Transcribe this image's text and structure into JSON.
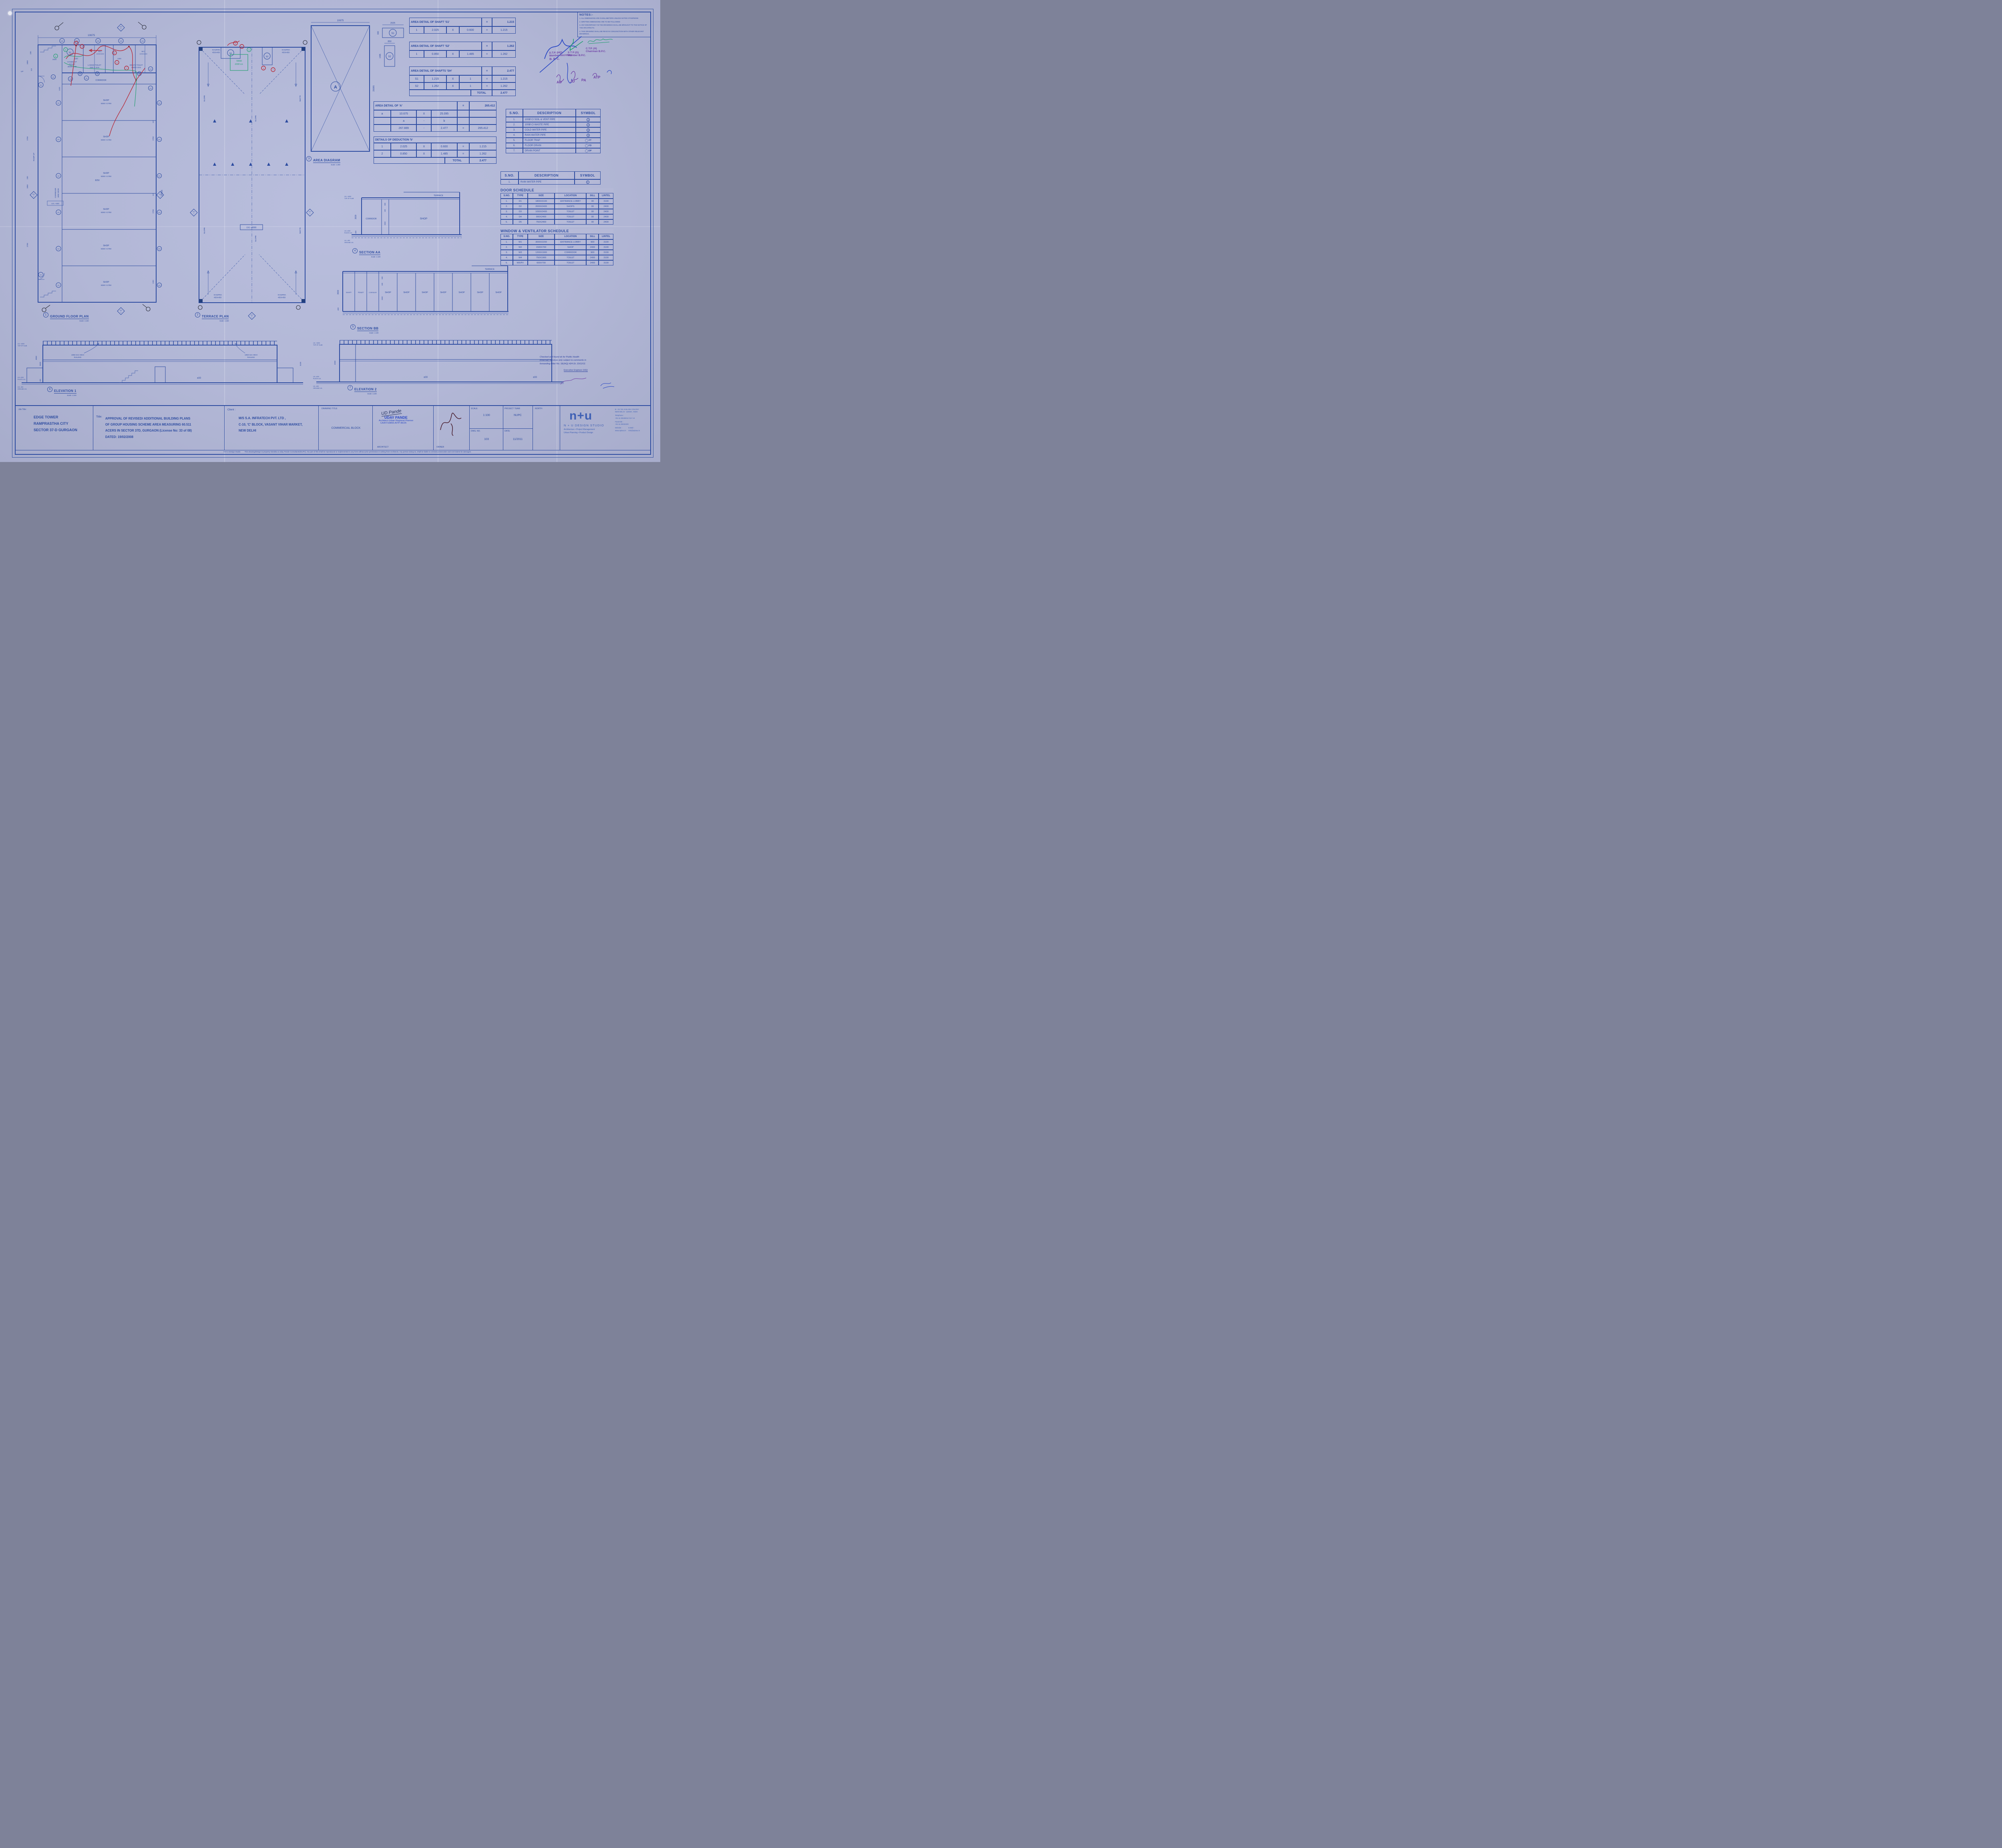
{
  "palette": {
    "paper": "#b6bbd8",
    "ink": "#2c4ba0",
    "red": "#b7202e",
    "green": "#1d9e6d",
    "purple": "#6f41a6",
    "pen_blue": "#2a3f9e"
  },
  "notes": {
    "title": "NOTES:-",
    "items": [
      "1.   ALL DIMENSIONS ARE IN MILLIMETERS UNLESS NOTED OTHERWISE",
      "2.   WRITTEN DIMENSIONS ARE TO BE FOLLOWED",
      "3.   ANY DISCRIPANCY IN THE DRAWINGS SHALL BE BROUGHT TO THE NOTICE OF THE ARCHITECTS.",
      "4.   THIS DRAWING SHALL BE READ IN CONJUNCTION WITH OTHER RELEVANT DRAWINGS."
    ]
  },
  "approvals": {
    "dtp": [
      "D.T.P. (HQ)",
      "Member Secretary",
      "B. P. C."
    ],
    "stp": [
      "S T P (G)",
      "Member B.P.C."
    ],
    "ctp": [
      "C.T.P. (H)",
      "Chairman B.P.C."
    ],
    "initials": [
      "AD",
      "JD",
      "PA",
      "ATP"
    ]
  },
  "shaft_s1": {
    "title": "AREA DETAIL OF  SHAFT 'S1'",
    "eq": "=",
    "total": "1.215",
    "rows": [
      [
        "1",
        "2.025",
        "X",
        "0.600",
        "=",
        "1.215"
      ]
    ]
  },
  "shaft_s2": {
    "title": "AREA DETAIL OF  SHAFT 'S2'",
    "eq": "=",
    "total": "1.262",
    "rows": [
      [
        "1",
        "0.850",
        "X",
        "1.485",
        "=",
        "1.262"
      ]
    ]
  },
  "shaft_sh": {
    "title": "AREA DETAIL OF  SHAFTS 'SH'",
    "eq": "=",
    "total": "2.477",
    "rows": [
      [
        "S1",
        "1.215",
        "X",
        "1",
        "=",
        "1.215"
      ],
      [
        "S2",
        "1.262",
        "X",
        "1",
        "=",
        "1.262"
      ]
    ],
    "footer_label": "TOTAL",
    "footer_value": "2.477"
  },
  "area_a": {
    "title": "AREA DETAIL OF 'A'",
    "eq": "=",
    "total": "265.412",
    "rows": [
      [
        "a",
        "10.675",
        "X",
        "25.095",
        "",
        ""
      ],
      [
        "",
        "a",
        "-",
        "b",
        "",
        ""
      ],
      [
        "",
        "267.889",
        "-",
        "2.477",
        "=",
        "265.412"
      ]
    ]
  },
  "deduction_b": {
    "title": "DETAILS OF DEDUCTION 'b'",
    "rows": [
      [
        "1",
        "2.025",
        "X",
        "0.600",
        "=",
        "1.215"
      ],
      [
        "2",
        "0.850",
        "X",
        "1.485",
        "=",
        "1.262"
      ]
    ],
    "footer_label": "TOTAL",
    "footer_value": "2.477"
  },
  "legend": {
    "headers": [
      "S.NO.",
      "DESCRIPTION",
      "SYMBOL"
    ],
    "rows": [
      {
        "no": "1.",
        "desc": "100Ø CI SOIL & VENT PIPE",
        "sym": "1",
        "type": "num"
      },
      {
        "no": "2.",
        "desc": "100Ø CI WASTE PIPE",
        "sym": "2",
        "type": "num"
      },
      {
        "no": "3.",
        "desc": "COLD WATER PIPE",
        "sym": "3",
        "type": "num"
      },
      {
        "no": "4.",
        "desc": "RAIN WATER PIPE",
        "sym": "4",
        "type": "num"
      },
      {
        "no": "5.",
        "desc": "FLOOR TRAP",
        "sym": "FT",
        "type": "dot"
      },
      {
        "no": "6.",
        "desc": "FLOOR DRAIN",
        "sym": "FD",
        "type": "dot"
      },
      {
        "no": "7.",
        "desc": "DRAIN POINT",
        "sym": "DP",
        "type": "dot"
      }
    ]
  },
  "legend2": {
    "headers": [
      "S.NO.",
      "DESCRIPTION",
      "SYMBOL"
    ],
    "rows": [
      {
        "no": "1.",
        "desc": "RAIN WATER PIPE",
        "sym": "1",
        "type": "num"
      }
    ]
  },
  "door_schedule": {
    "title": "DOOR SCHEDULE",
    "headers": [
      "S.NO.",
      "TYPE",
      "SIZE",
      "LOCATION",
      "SILL",
      "LINTEL"
    ],
    "rows": [
      [
        "1.",
        "D1",
        "1800X3100",
        "ENTRANCE LOBBY",
        "00",
        "3100"
      ],
      [
        "2.",
        "D2",
        "2000X2400",
        "SHOPS",
        "00",
        "2400"
      ],
      [
        "3.",
        "D3",
        "1050X2400",
        "TOILET",
        "00",
        "2400"
      ],
      [
        "4.",
        "D4",
        "900X2400",
        "TOILET",
        "00",
        "2400"
      ],
      [
        "5.",
        "D5",
        "750X2400",
        "TOILET",
        "00",
        "2400"
      ]
    ]
  },
  "window_schedule": {
    "title": "WINDOW & VENTILATOR SCHEDULE",
    "headers": [
      "S.NO.",
      "TYPE",
      "SIZE",
      "LOCATION",
      "SILL",
      "LINTEL"
    ],
    "rows": [
      [
        "1.",
        "W1",
        "3000X2200",
        "ENTRANCE LOBBY",
        "900",
        "3100"
      ],
      [
        "2.",
        "W2",
        "1500X700",
        "SHOP",
        "2400",
        "3100"
      ],
      [
        "3.",
        "W3",
        "1200X1900",
        "CORRIDOR",
        "900",
        "3100"
      ],
      [
        "4.",
        "W4",
        "750X1900",
        "TOILET",
        "2400",
        "3100"
      ],
      [
        "5.",
        "W5/PV",
        "600X700",
        "TOILET",
        "2400",
        "3100"
      ]
    ]
  },
  "drawing_labels": {
    "ground": {
      "num": "1",
      "title": "GROUND FLOOR PLAN",
      "scale": "Scale: 1:100"
    },
    "terrace": {
      "num": "2",
      "title": "TERRACE PLAN",
      "scale": "Scale: 1:100"
    },
    "area": {
      "num": "3",
      "title": "AREA DIAGRAM",
      "scale": "Scale: 1:200"
    },
    "secaa": {
      "num": "4",
      "title": "SECTION AA",
      "scale": "Scale: 1:100"
    },
    "secbb": {
      "num": "5",
      "title": "SECTION BB",
      "scale": "Scale: 1:100"
    },
    "elev1": {
      "num": "6",
      "title": "ELEVATION 1",
      "scale": "Scale: 1:100"
    },
    "elev2": {
      "num": "7",
      "title": "ELEVATION 2",
      "scale": "Scale: 1:100"
    }
  },
  "ground": {
    "dim_top": "10675",
    "dim_right": "25095",
    "w5": "W5",
    "d230": "230",
    "d1850": "1850",
    "d2025": "2025",
    "d115": "115",
    "d1200": "1200",
    "d1445": "1445",
    "d2750": "2750",
    "d8250": "8250",
    "d1250": "1250",
    "handicap": [
      "HANDICAP",
      "TOILET",
      "2000X 2305"
    ],
    "ladies": [
      "LADIES TOILET",
      "2500 X 3215"
    ],
    "gents": [
      "GENTS TOILET",
      "2500 X 3215"
    ],
    "wc": [
      "W.C.",
      "1200X1500"
    ],
    "corridor_top": "CORRIDOR",
    "corridor_left": [
      "CORRIDOR",
      "1850 WIDE"
    ],
    "ramp": "RAMP UP",
    "up": "UP",
    "lvl": "LVL +450",
    "shop_label": [
      "SHOP",
      "8250 X 2750"
    ],
    "tags": {
      "d1": "D1",
      "d2": "D2",
      "d3": "D3",
      "d4": "D4",
      "d5": "D5",
      "w2": "W2",
      "w3": "W3",
      "w4": "W4",
      "s1": "S1"
    },
    "sec_a": [
      "SEC",
      "A"
    ],
    "sec_b": [
      "SEC",
      "B"
    ]
  },
  "terrace": {
    "khurra": [
      "KHURRA",
      "450X450"
    ],
    "slope": "SLOPE",
    "tank": [
      "TANK",
      "1000 Ltr."
    ],
    "lvl": "LVL +4000",
    "s1": "S1",
    "s2": "S2"
  },
  "area_diagram": {
    "a": "A",
    "dim_top": "10675",
    "dim_right": "25095"
  },
  "shaft_detail": {
    "s1": "S1",
    "s1_w": "2025",
    "s1_h": "600",
    "s2": "S2",
    "s2_w": "850",
    "s2_h": "1485"
  },
  "section_aa": {
    "terrace": "TERRACE",
    "corridor": "CORRIDOR",
    "shop": "SHOP",
    "d3600": "3600",
    "d450": "450",
    "d150": "150",
    "d600": "600",
    "d3450": "3450",
    "levels": [
      [
        "LVL +4000",
        "TOP OF SLAB"
      ],
      [
        "LVL ±000",
        "PLINTH LVL"
      ],
      [
        "LVL -600",
        "GROUND LVL"
      ]
    ]
  },
  "section_bb": {
    "terrace": "TERRACE",
    "shaft": "SHAFT",
    "toilet": "TOILET",
    "corridor": "CORRIDOR",
    "shop": "SHOP",
    "d3600": "3600",
    "d450": "450",
    "d150": "150",
    "d600": "600",
    "d3450": "3450"
  },
  "elevation1": {
    "railing": [
      "1050 mm HIGH",
      "RAILING"
    ],
    "pm": "±00",
    "d4850": "4850",
    "d3600": "3600",
    "d450": "450",
    "d3100": "3100"
  },
  "elevation2": {
    "pm": "±00",
    "d4000": "4000"
  },
  "checked_stamp": {
    "lines": [
      "Checked and found ok for Public Health",
      "(Internal) Services only subject to comments in",
      "forwarding letter No. SE(HQ) 424  Dt. 23/12/11"
    ],
    "sign": "Executive Engineer (HQ)"
  },
  "annotations": {
    "red": [
      "1",
      "2",
      "3",
      "4",
      "7"
    ],
    "green": [
      "5",
      "6"
    ]
  },
  "title_block": {
    "job_title_label": "Job Title :",
    "job_title_lines": [
      "EDGE TOWER",
      "RAMPRASTHA  CITY",
      "SECTOR 37-D GURGAON"
    ],
    "title_label": "Title:",
    "title_lines": [
      "APPROVAL OF REVISED/ ADDITIONAL BUILDING PLANS",
      "OF GROUP HOUSING SCHEME AREA MEASURING 60.511",
      "ACERS IN SECTOR 37D, GURGAON  (License No: 33 of 08)",
      "DATED: 19/02/2008"
    ],
    "client_label": "Client :",
    "client_lines": [
      "M/S S.A. INFRATECH PVT. LTD ,",
      "C-10, 'C' BLOCK, VASANT VIHAR MARKET,",
      "NEW DELHI"
    ],
    "drawing_title_label": "DRAWING TITLE:",
    "drawing_title": "COMMERCIAL BLOCK",
    "architect_hand": "UD Pande",
    "architect_stamp": [
      "UDAY PANDE",
      "Architect-Urban Regional Planner",
      "CA/87/10856-AITP-86/26"
    ],
    "architect_label": "ARCHITECT",
    "owner_label": "OWNER",
    "scale_label": "SCALE:",
    "scale_value": "1:100",
    "dwg_label": "DWG. NO.",
    "dwg_value": "103",
    "team_label": "PROJECT TEAM:",
    "team_value": "NUPC",
    "date_label": "DATE:",
    "date_value": "11/2011",
    "north_label": "NORTH:",
    "logo_mark": "n+u",
    "logo_name": "N + U DESIGN STUDIO",
    "logo_line1": "Architecture     •   Project  Management",
    "logo_line2": "Urban  Planning     •   Product   Design",
    "address_lines": [
      "B - 23 / 25, KAILASH COLONY",
      "NEW DELHI - 110048 , INDIA"
    ],
    "phone_label": "Telephone :",
    "phone": "+91-11-29246012 /13 / 14",
    "fax_label": "Facsimile :",
    "fax": "+91-11-29234320",
    "web_label": "Website :",
    "web": "www.nplusu.in",
    "email_label": "E.Mail :",
    "email": "info@nplusu.in",
    "copyright": "©N+U Design Studio",
    "disclaimer": "This drawing/design is property Nivedita & Uday Pande Consultants(NUPC). No part of this shall be reproduced or implemented in any form without prior permission in writing from Architects. Any person doing so, shall  be  liable to criminal  prosecution  and  civil  claims  for  damages."
  }
}
